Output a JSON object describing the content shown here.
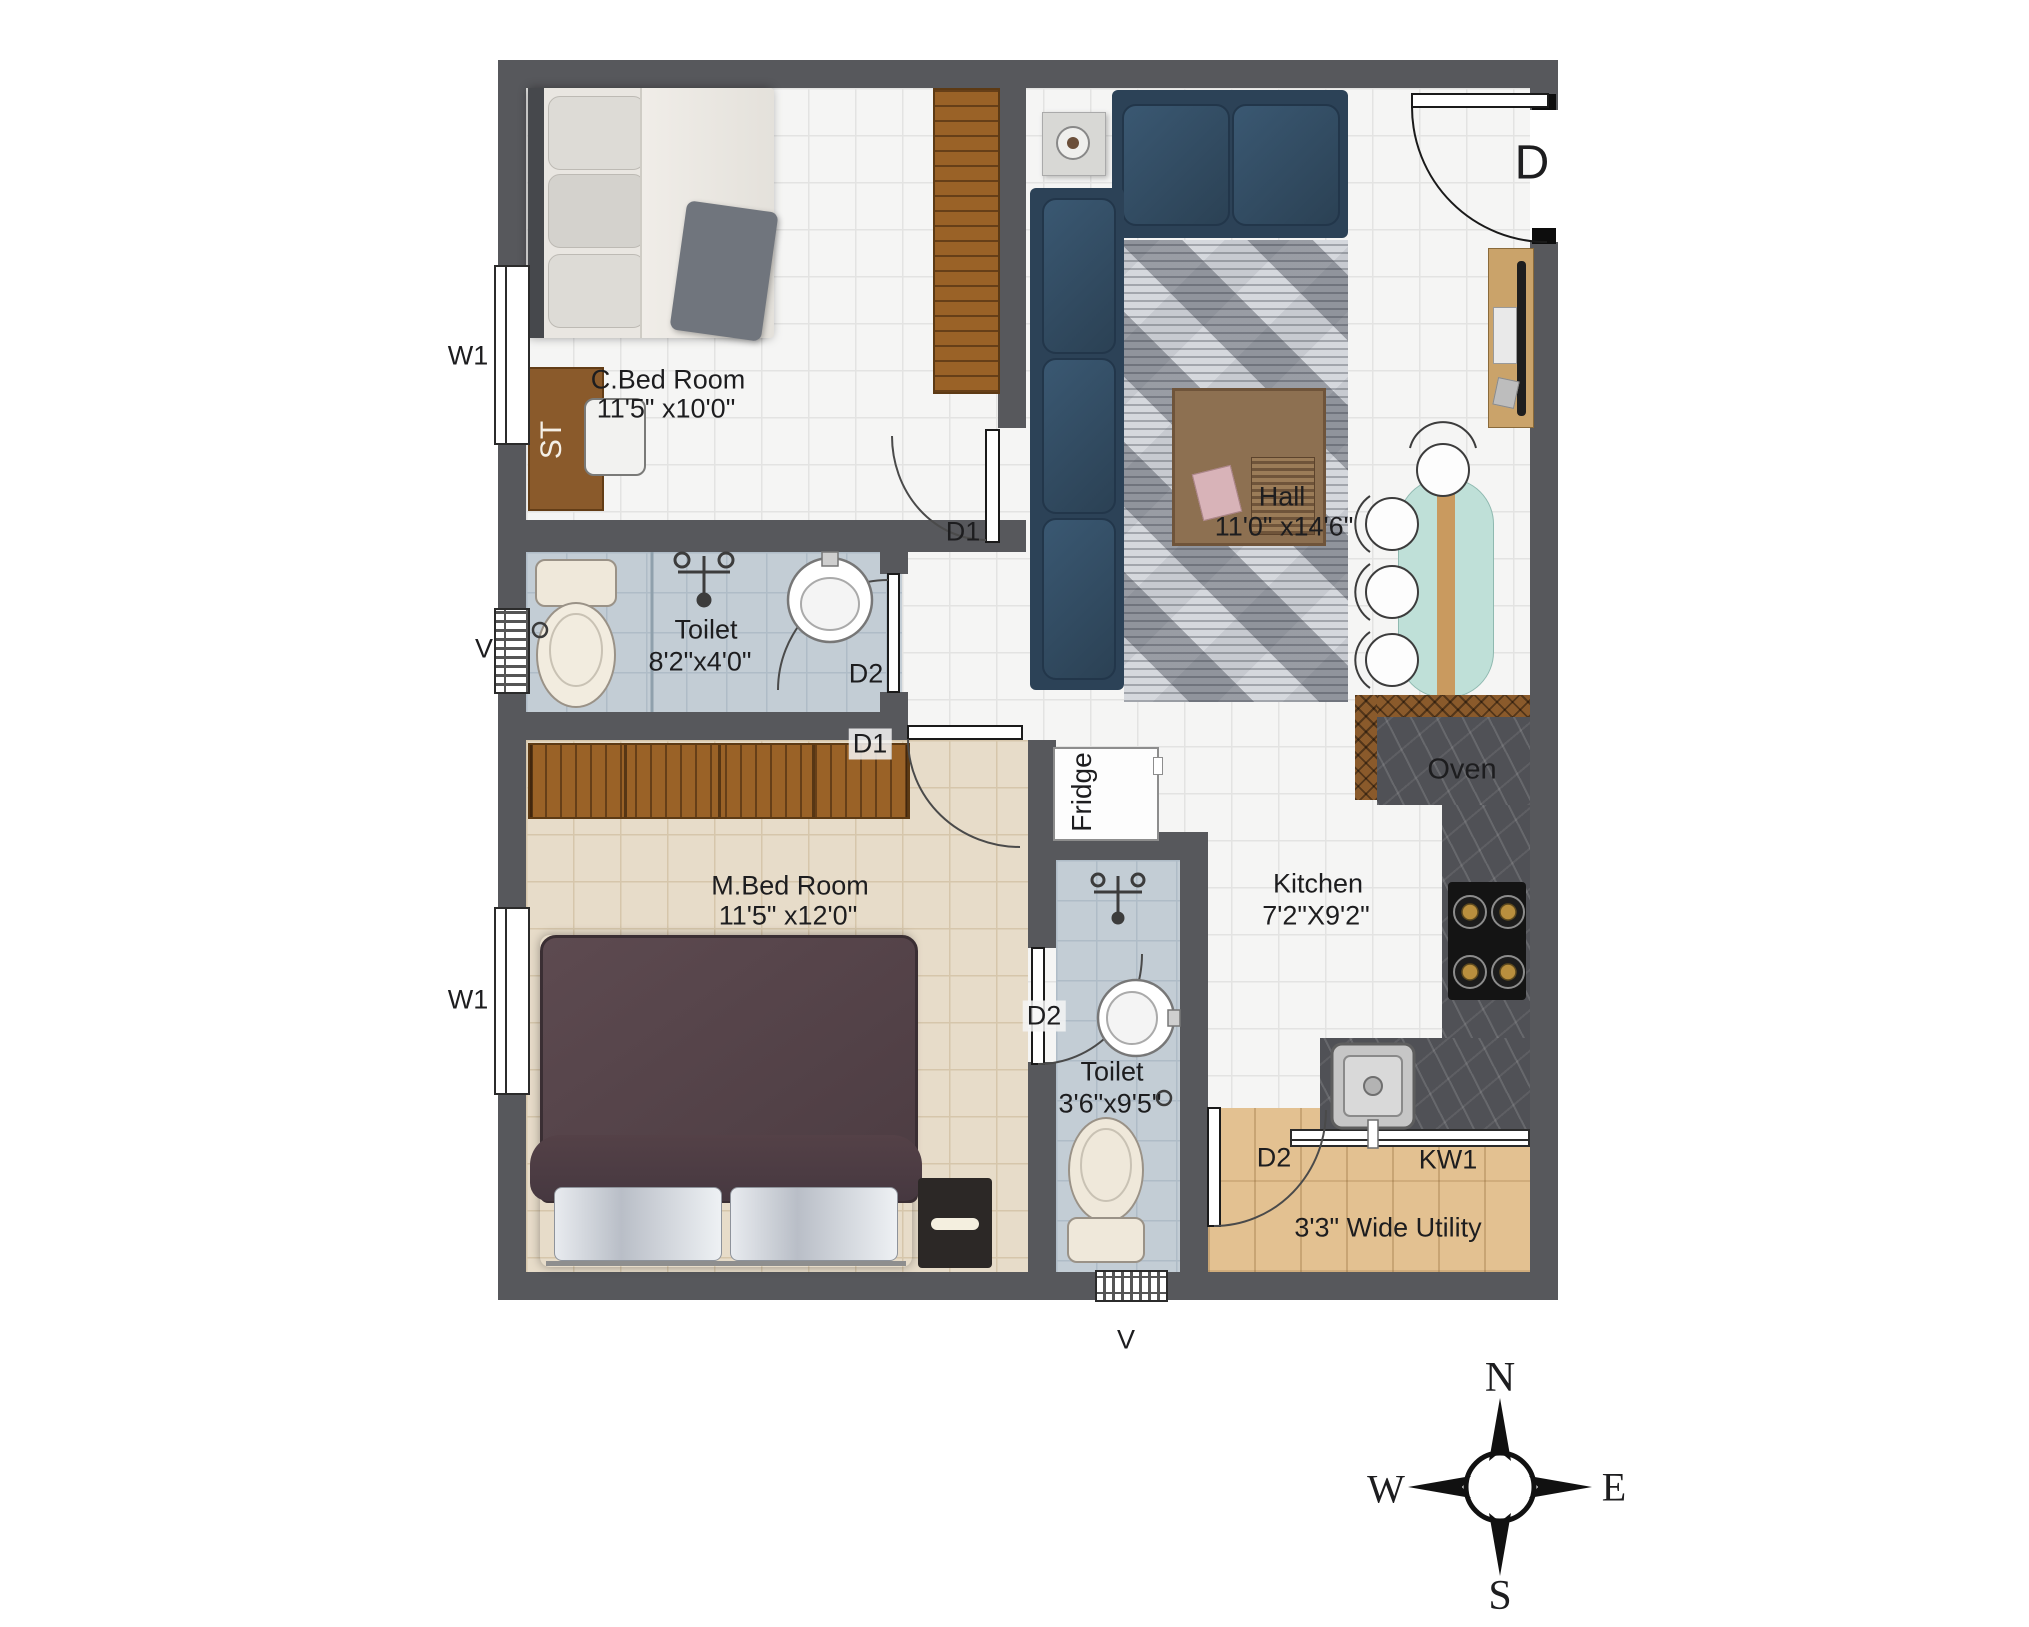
{
  "rooms": [
    {
      "name": "C.Bed Room",
      "dims": "11'5\" x10'0\""
    },
    {
      "name": "Hall",
      "dims": "11'0\" x14'6\""
    },
    {
      "name": "Toilet",
      "dims": "8'2\"x4'0\""
    },
    {
      "name": "M.Bed Room",
      "dims": "11'5\" x12'0\""
    },
    {
      "name": "Toilet",
      "dims": "3'6\"x9'5\""
    },
    {
      "name": "Kitchen",
      "dims": "7'2\"X9'2\""
    },
    {
      "name": "3'3\" Wide Utility"
    }
  ],
  "tags": {
    "entrance_door": "D",
    "door_d1": "D1",
    "door_d2": "D2",
    "window_w1": "W1",
    "ventilator": "V",
    "kitchen_window": "KW1",
    "study_table": "ST",
    "fridge": "Fridge",
    "oven": "Oven"
  },
  "compass": {
    "north": "N",
    "east": "E",
    "south": "S",
    "west": "W"
  },
  "colors": {
    "wall": "#57585c",
    "toilet_floor": "#c3cdd5",
    "master_floor": "#e7dcc9",
    "utility_floor": "#e3c191",
    "sofa": "#2c4257",
    "counter_marble": "#505156",
    "dining_table": "#bfe0d8",
    "wood": "#9a6227"
  }
}
